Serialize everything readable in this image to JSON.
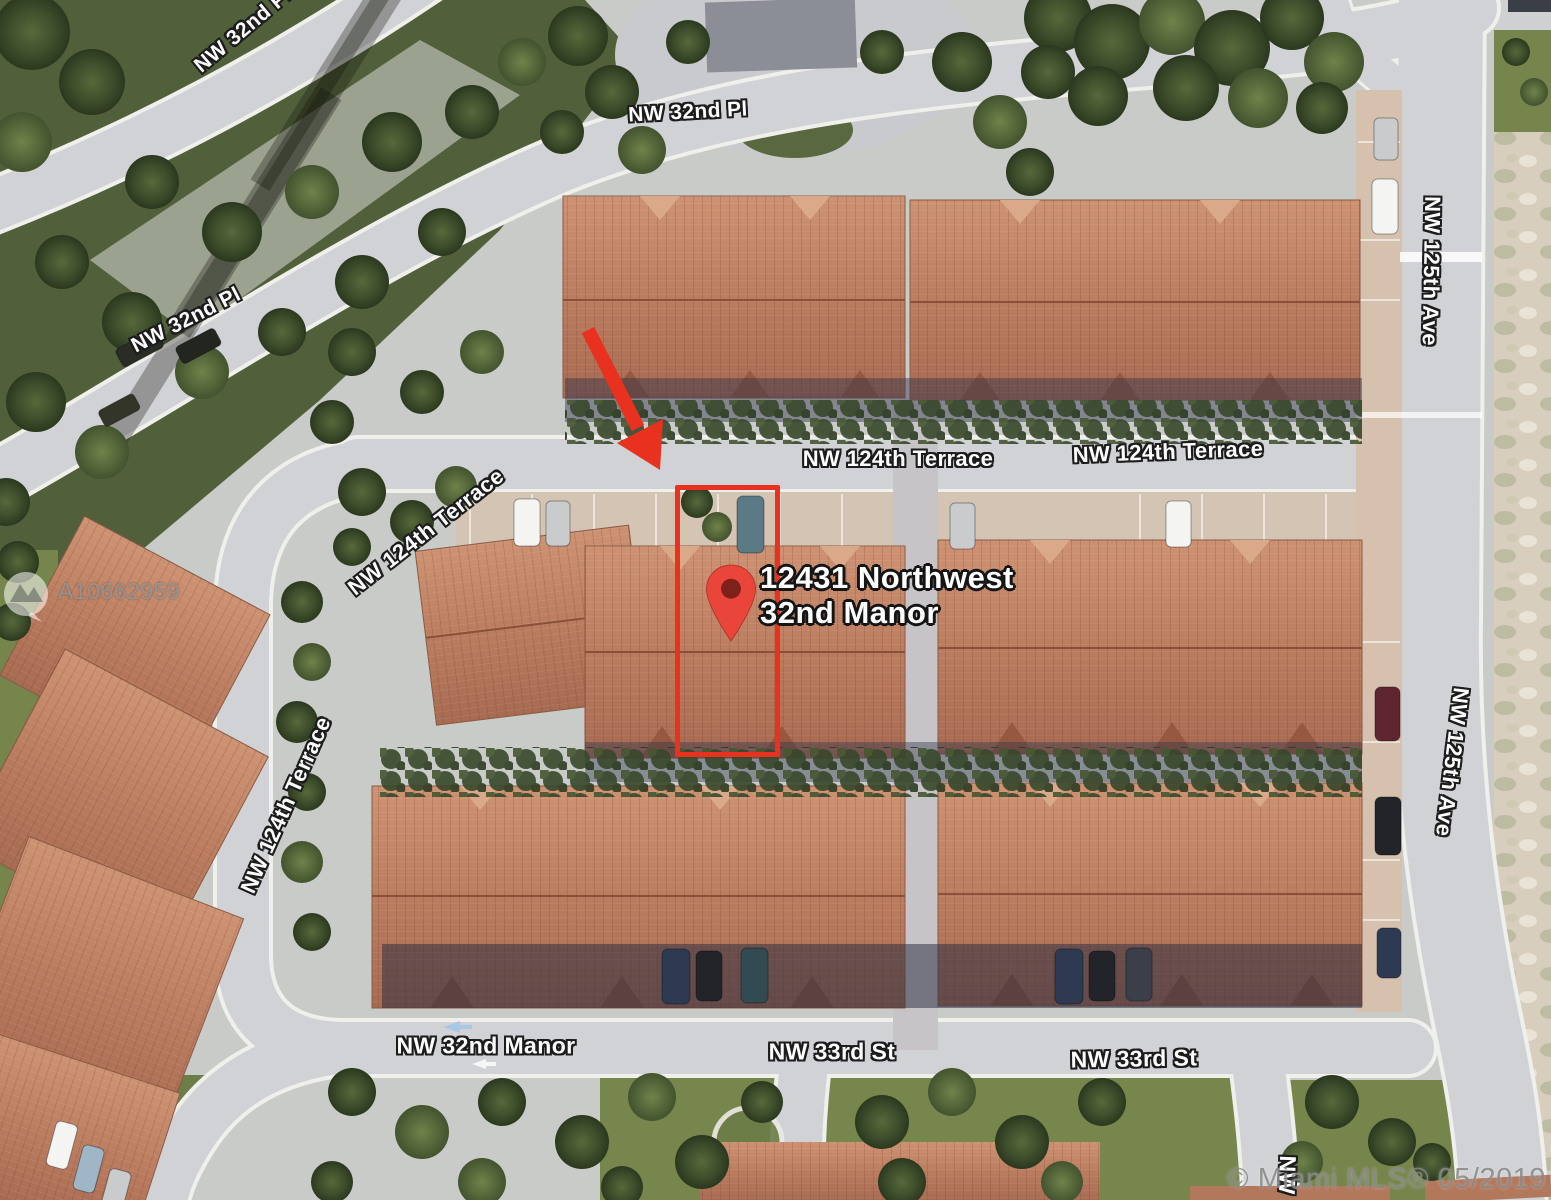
{
  "map": {
    "type": "satellite",
    "street_labels": [
      {
        "id": "nw-32nd-pl-topleft",
        "text": "NW 32nd Pl"
      },
      {
        "id": "nw-32nd-pl-left",
        "text": "NW 32nd Pl"
      },
      {
        "id": "nw-32nd-pl-top",
        "text": "NW 32nd Pl"
      },
      {
        "id": "nw-124th-terrace-west-upper",
        "text": "NW 124th Terrace"
      },
      {
        "id": "nw-124th-terrace-center",
        "text": "NW 124th Terrace"
      },
      {
        "id": "nw-124th-terrace-east",
        "text": "NW 124th Terrace"
      },
      {
        "id": "nw-124th-terrace-west-lower",
        "text": "NW 124th Terrace"
      },
      {
        "id": "nw-125th-ave-upper",
        "text": "NW 125th Ave"
      },
      {
        "id": "nw-125th-ave-lower",
        "text": "NW 125th Ave"
      },
      {
        "id": "nw-32nd-manor",
        "text": "NW 32nd Manor"
      },
      {
        "id": "nw-33rd-st-west",
        "text": "NW 33rd St"
      },
      {
        "id": "nw-33rd-st-east",
        "text": "NW 33rd St"
      },
      {
        "id": "nw-partial-bottom",
        "text": "NW"
      }
    ]
  },
  "marker": {
    "address_line1": "12431 Northwest",
    "address_line2": "32nd Manor",
    "pin_icon": "map-pin",
    "pin_color": "#e9453a"
  },
  "annotations": {
    "highlight_color": "#e8321f",
    "arrow_icon": "red-arrow",
    "rectangle": "property-outline"
  },
  "watermarks": {
    "mls_id": "A10662959",
    "badge_icon": "photo-camera",
    "copyright": "© Miami MLS® 05/2019"
  },
  "palette": {
    "roof": "#bb7d60",
    "road": "#d1d2d5",
    "vegetation": "#3c4b2a",
    "grass": "#75854c",
    "sand": "#d7cebd"
  }
}
